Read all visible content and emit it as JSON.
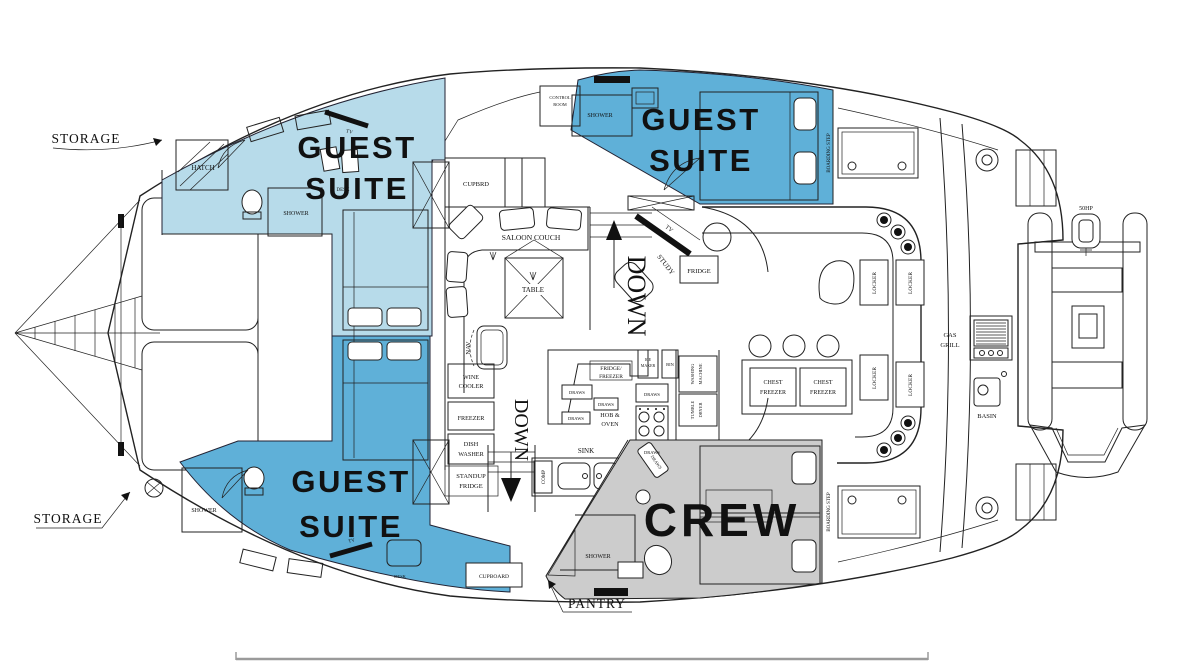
{
  "labels": {
    "storage": "STORAGE",
    "pantry": "PANTRY",
    "guest": "GUEST",
    "suite": "SUITE",
    "crew": "CREW",
    "hatch": "HATCH",
    "shower": "SHOWER",
    "tv": "TV",
    "desk": "DESK",
    "control1": "CONTROL",
    "control2": "ROOM",
    "cupbrd": "CUPBRD",
    "saloon_couch": "SALOON COUCH",
    "table": "TABLE",
    "down": "DOWN",
    "study": "STUDY",
    "fridge": "FRIDGE",
    "nav": "NAV",
    "wine1": "WINE",
    "wine2": "COOLER",
    "freezer": "FREEZER",
    "dish1": "DISH",
    "dish2": "WASHER",
    "standup1": "STANDUP",
    "standup2": "FRIDGE",
    "ff1": "FRIDGE/",
    "ff2": "FREEZER",
    "draws": "DRAWS",
    "ice1": "ICE",
    "ice2": "MAKER",
    "bin": "BIN",
    "hob1": "HOB &",
    "hob2": "OVEN",
    "wash1": "WASHING",
    "wash2": "MACHINE",
    "dry1": "TUMBLE",
    "dry2": "DRYER",
    "sink": "SINK",
    "comp": "COMP",
    "cupboard": "CUPBOARD",
    "locker": "LOCKER",
    "chest1": "CHEST",
    "chest2": "FREEZER",
    "gas1": "GAS",
    "gas2": "GRILL",
    "basin": "BASIN",
    "boarding": "BOARDING STEP",
    "hp": "50HP"
  },
  "colors": {
    "suite_light": "#b7dbea",
    "suite_dark": "#5fb0d8",
    "crew_area": "#cccccc",
    "line": "#222222",
    "text_white": "#ffffff",
    "text_black": "#111111",
    "scale_bar": "#9a9a9a"
  }
}
